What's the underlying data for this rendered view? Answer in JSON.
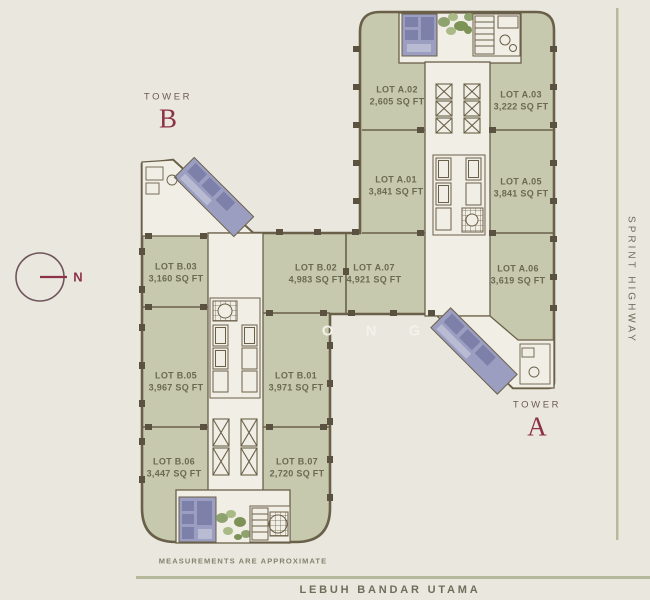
{
  "towers": {
    "b": {
      "label": "TOWER",
      "letter": "B"
    },
    "a": {
      "label": "TOWER",
      "letter": "A"
    }
  },
  "compass": {
    "label": "N"
  },
  "roads": {
    "right": "SPRINT HIGHWAY",
    "bottom": "LEBUH BANDAR UTAMA"
  },
  "note": "MEASUREMENTS ARE APPROXIMATE",
  "watermark": "O N G",
  "lots": [
    {
      "id": "LOT A.02",
      "area": "2,605 SQ FT"
    },
    {
      "id": "LOT A.03",
      "area": "3,222 SQ FT"
    },
    {
      "id": "LOT A.01",
      "area": "3,841 SQ FT"
    },
    {
      "id": "LOT A.05",
      "area": "3,841 SQ FT"
    },
    {
      "id": "LOT B.03",
      "area": "3,160 SQ FT"
    },
    {
      "id": "LOT B.02",
      "area": "4,983 SQ FT"
    },
    {
      "id": "LOT A.07",
      "area": "4,921 SQ FT"
    },
    {
      "id": "LOT A.06",
      "area": "3,619 SQ FT"
    },
    {
      "id": "LOT B.05",
      "area": "3,967 SQ FT"
    },
    {
      "id": "LOT B.01",
      "area": "3,971 SQ FT"
    },
    {
      "id": "LOT B.06",
      "area": "3,447 SQ FT"
    },
    {
      "id": "LOT B.07",
      "area": "2,720 SQ FT"
    }
  ],
  "colors": {
    "background": "#eae7df",
    "lot_green": "#c6c9ad",
    "core_cream": "#f1eee5",
    "wall": "#6a6049",
    "column_tick": "#5b5140",
    "restroom_purple": "#9b9ec0",
    "restroom_purple_dark": "#7d80a8",
    "plant_green": "#8da26e",
    "accent_maroon": "#8c3247",
    "label_text": "#6b6954",
    "road_line": "#b7b99c"
  }
}
